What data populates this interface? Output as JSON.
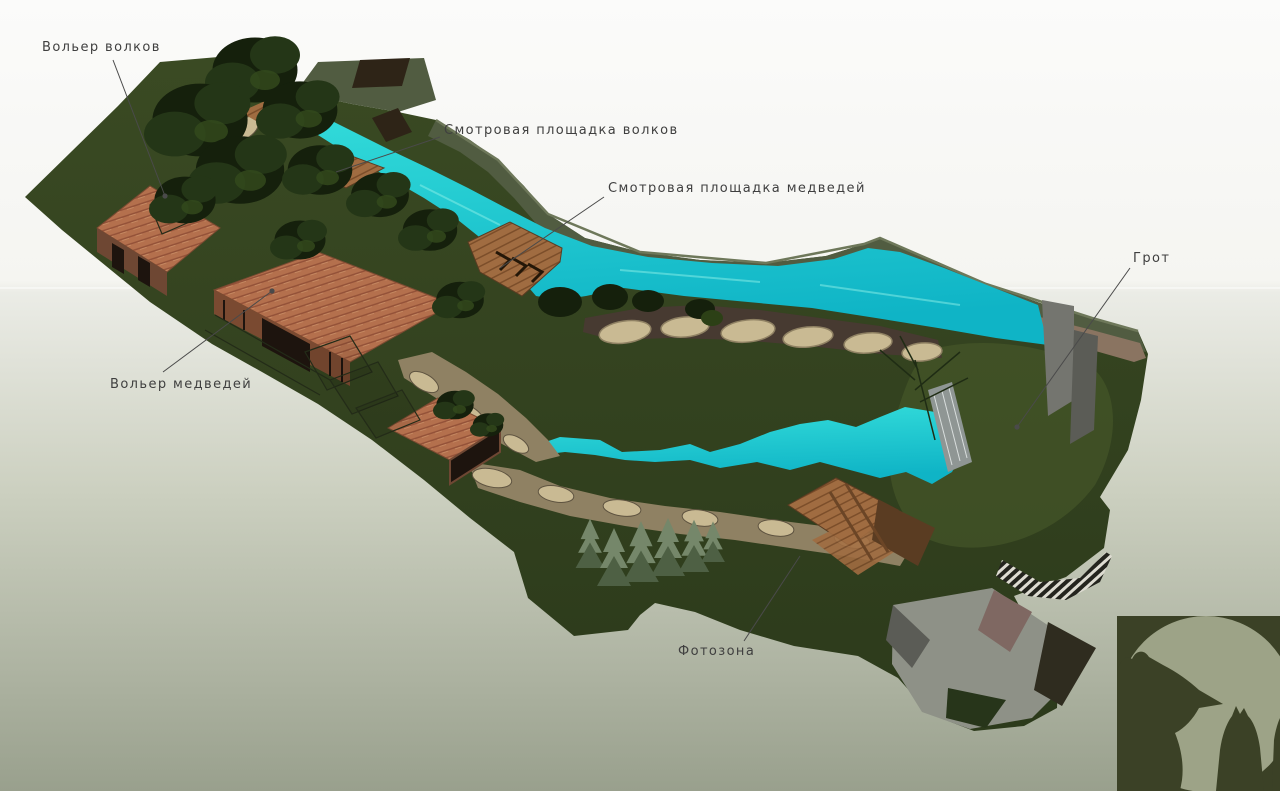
{
  "scene": {
    "title": "Zoo enclosure masterplan rendering",
    "bg": {
      "top": "#fbfbfa",
      "upper": "#f5f5f1",
      "horizon": "#ebece6",
      "mid": "#ccd0c0",
      "bottom": "#99a08d"
    },
    "colors": {
      "grass": "#33421f",
      "grass_dark": "#27351a",
      "grass_light": "#46582a",
      "bank": "#515c41",
      "bank_edge": "#6e785a",
      "water": "#35dedb",
      "water_deep": "#0fb4c6",
      "dirt": "#473a31",
      "rock_light": "#c9ba93",
      "rock_mid": "#8f8163",
      "rock_dark": "#5e5340",
      "brick": "#b4704d",
      "brick_line": "#935138",
      "brick_shadow": "#7a4a31",
      "building_face": "#6e4733",
      "opening_dark": "#1d140e",
      "wood": "#a06c41",
      "wood_dark": "#5a3c22",
      "tree_dark": "#15200c",
      "tree_mid": "#243617",
      "tree_light": "#33491c",
      "conifer": "#75876a",
      "conifer_dark": "#4e6044",
      "wall_gray": "#74756f",
      "wall_gray_dark": "#5b5c56",
      "path_gray": "#8e9187",
      "path_brown": "#7f6862",
      "path_dark": "#2f2c1f",
      "tan_band": "#8a7461",
      "dark_roof": "#2e2417",
      "stripe_light": "#dedcd2",
      "stripe_dark": "#24241e",
      "waterfall": "#8f9694",
      "label": "#3f3f3f",
      "leader": "#4a4a4a"
    }
  },
  "labels": [
    {
      "id": "wolf-enclosure",
      "text": "Вольер волков",
      "x": 42,
      "y": 51,
      "line": [
        113,
        60,
        165,
        196
      ],
      "dot": [
        165,
        196
      ]
    },
    {
      "id": "wolf-viewpoint",
      "text": "Смотровая площадка волков",
      "x": 444,
      "y": 134,
      "line": [
        440,
        137,
        336,
        172
      ],
      "dot": null
    },
    {
      "id": "bear-viewpoint",
      "text": "Смотровая площадка медведей",
      "x": 608,
      "y": 192,
      "line": [
        604,
        197,
        500,
        268
      ],
      "dot": null
    },
    {
      "id": "grotto",
      "text": "Грот",
      "x": 1133,
      "y": 262,
      "line": [
        1130,
        268,
        1017,
        427
      ],
      "dot": [
        1017,
        427
      ]
    },
    {
      "id": "bear-enclosure",
      "text": "Вольер медведей",
      "x": 110,
      "y": 388,
      "line": [
        163,
        372,
        272,
        291
      ],
      "dot": [
        272,
        291
      ]
    },
    {
      "id": "photo-zone",
      "text": "Фотозона",
      "x": 678,
      "y": 655,
      "line": [
        744,
        641,
        800,
        556
      ],
      "dot": null
    }
  ],
  "logo": {
    "name": "bear-and-wolf-logo",
    "square": "#3b4126",
    "circle": "#9da387"
  }
}
